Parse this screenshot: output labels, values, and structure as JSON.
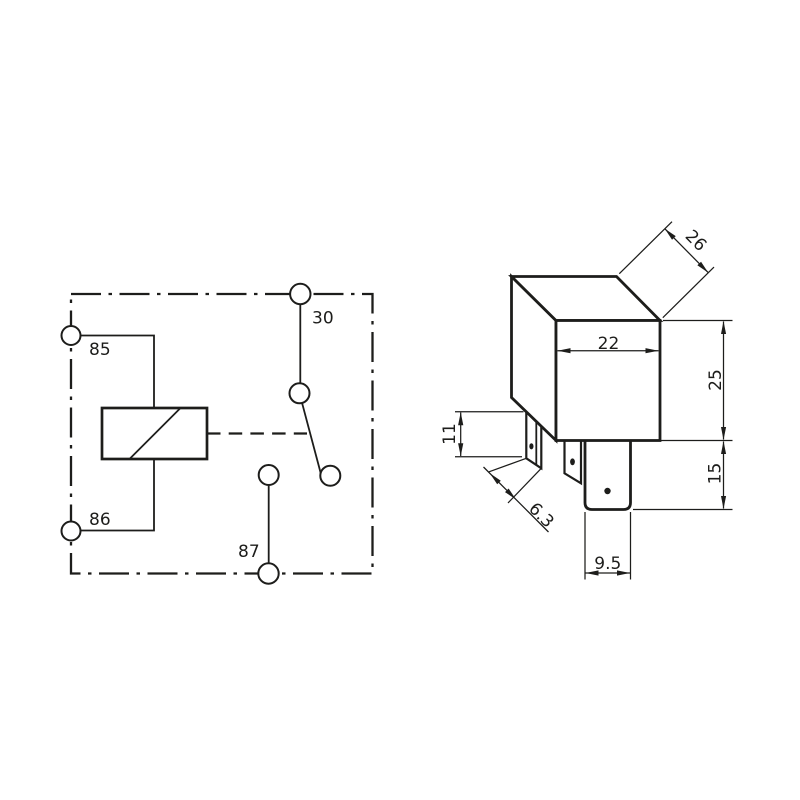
{
  "colors": {
    "background": "#ffffff",
    "ink": "#1d1d1b"
  },
  "schematic": {
    "terminals": {
      "t85": "85",
      "t86": "86",
      "t30": "30",
      "t87": "87"
    }
  },
  "dimension_drawing": {
    "dimensions": {
      "depth": "26",
      "width": "22",
      "body_height": "25",
      "pin_length": "15",
      "side_pin_height": "11",
      "side_pin_width": "6.3",
      "main_pin_width": "9.5"
    }
  }
}
